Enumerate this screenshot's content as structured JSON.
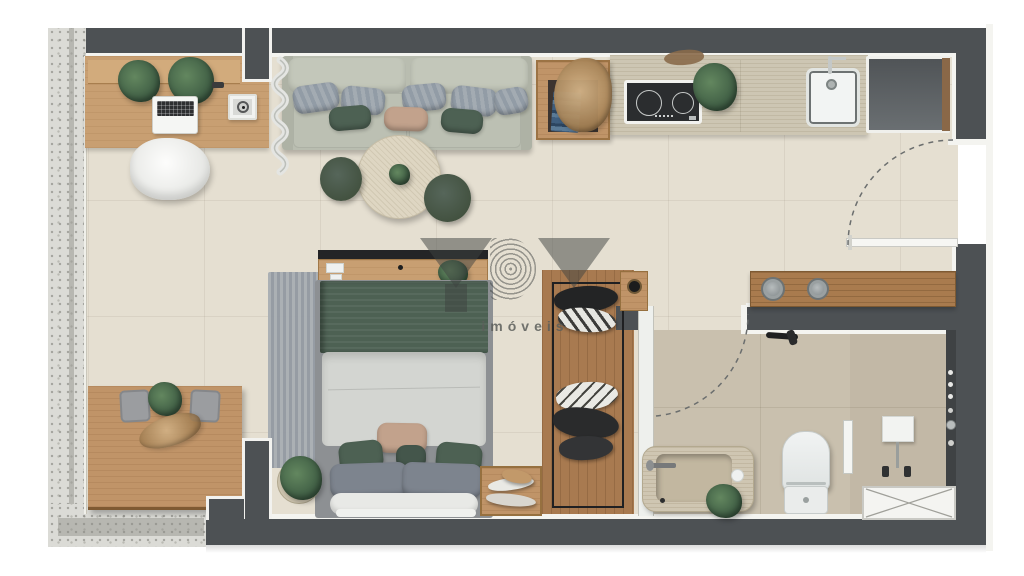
{
  "watermark": {
    "logo": "YBY",
    "tagline": "imóveis",
    "color": "#3e4140"
  },
  "palette": {
    "wall": "#4d5154",
    "baseboard": "#f4f4f0",
    "floor_living": "#e5dfd1",
    "floor_bath": "#c9c0ae",
    "floor_shower": "#c2b8a6",
    "floor_closet": "#a87a50",
    "terrace": "#dbdbd6",
    "wood_desk": "#c89f72",
    "wood_table": "#c09468",
    "wood_vanity": "#a97b4e",
    "counter": "#cdc6b3",
    "sofa": "#b9bdb0",
    "cushion_green": "#4d6153",
    "cushion_gray": "#9da7ae",
    "cushion_tan": "#c2a28c",
    "bed_blanket": "#4d6153",
    "bed_duvet": "#d3d5d1",
    "stool_green": "#4a5a4e",
    "fixture_white": "#eff1f0",
    "stone_basin": "#cfc6b2"
  }
}
